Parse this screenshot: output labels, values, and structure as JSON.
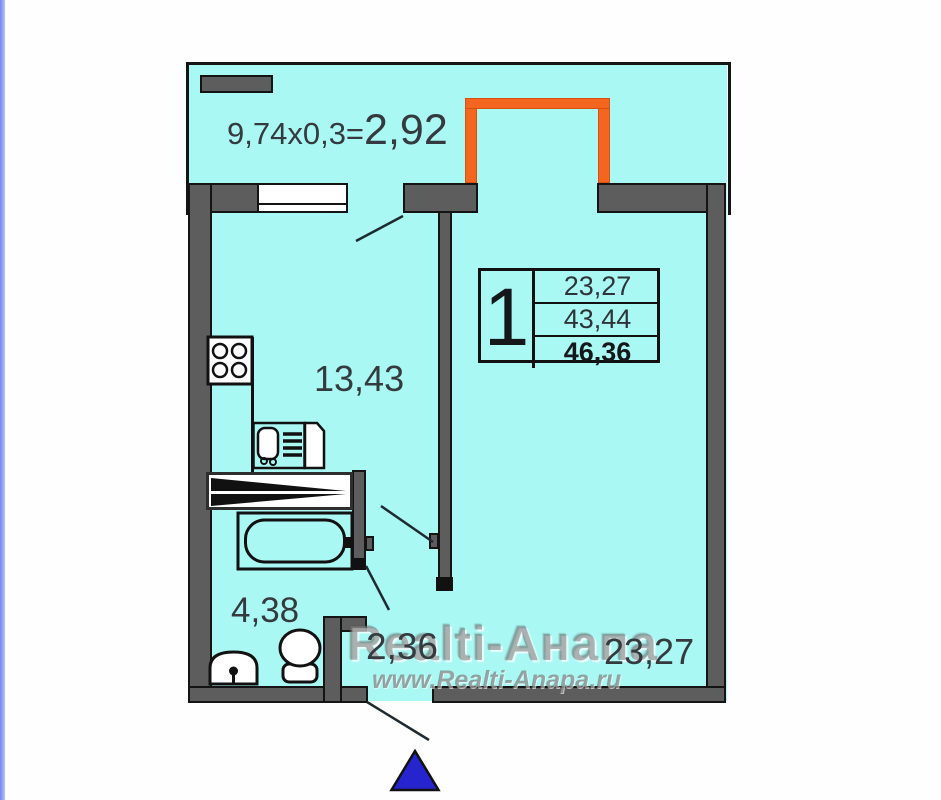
{
  "colors": {
    "room_fill": "#a9f8f3",
    "wall_fill": "#5d5d5d",
    "line_ink": "#141414",
    "accent_orange": "#f4661f",
    "arrow_blue": "#2524ce",
    "edge_stripe": "#7d90f0",
    "label_ink": "#343a3e"
  },
  "balcony": {
    "formula": "9,74x0,3=",
    "result": "2,92"
  },
  "info_box": {
    "apartment_number": "1",
    "rows": [
      "23,27",
      "43,44",
      "46,36"
    ]
  },
  "rooms": {
    "kitchen_area": "13,43",
    "bathroom_area": "4,38",
    "hallway_area": "2,36",
    "living_room_area": "23,27"
  },
  "watermark": {
    "agency": "Realti-Анапа",
    "website": "www.Realti-Anapa.ru"
  }
}
